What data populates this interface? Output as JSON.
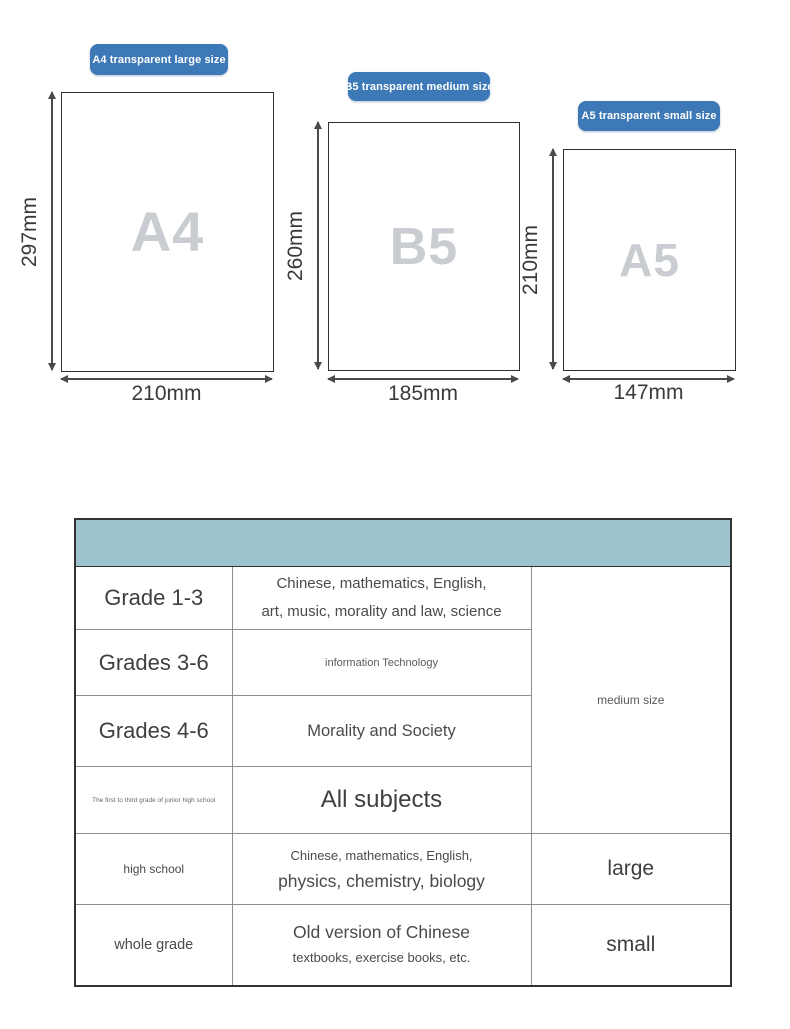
{
  "colors": {
    "badge_blue": "#3d79b6",
    "header_teal": "#9dc4ce",
    "watermark_gray": "#c9ccd0",
    "arrow_gray": "#4a4a4a"
  },
  "papers": [
    {
      "badge": "A4 transparent large size",
      "label": "A4",
      "height_label": "297mm",
      "width_label": "210mm"
    },
    {
      "badge": "B5 transparent medium size",
      "label": "B5",
      "height_label": "260mm",
      "width_label": "185mm"
    },
    {
      "badge": "A5 transparent small size",
      "label": "A5",
      "height_label": "210mm",
      "width_label": "147mm"
    }
  ],
  "table": {
    "header_label": "",
    "merged_size_label": "medium size",
    "rows": [
      {
        "grade": "Grade 1-3",
        "line1": "Chinese, mathematics, English,",
        "line2": "art, music, morality and law, science"
      },
      {
        "grade": "Grades 3-6",
        "line1": "information Technology"
      },
      {
        "grade": "Grades 4-6",
        "line1": "Morality and Society"
      },
      {
        "grade": "The first to third grade of junior high school",
        "line1": "All subjects"
      },
      {
        "grade": "high school",
        "line1": "Chinese, mathematics, English,",
        "line2": "physics, chemistry, biology",
        "size": "large"
      },
      {
        "grade": "whole grade",
        "line1": "Old version of Chinese",
        "line2": "textbooks, exercise books, etc.",
        "size": "small"
      }
    ]
  }
}
